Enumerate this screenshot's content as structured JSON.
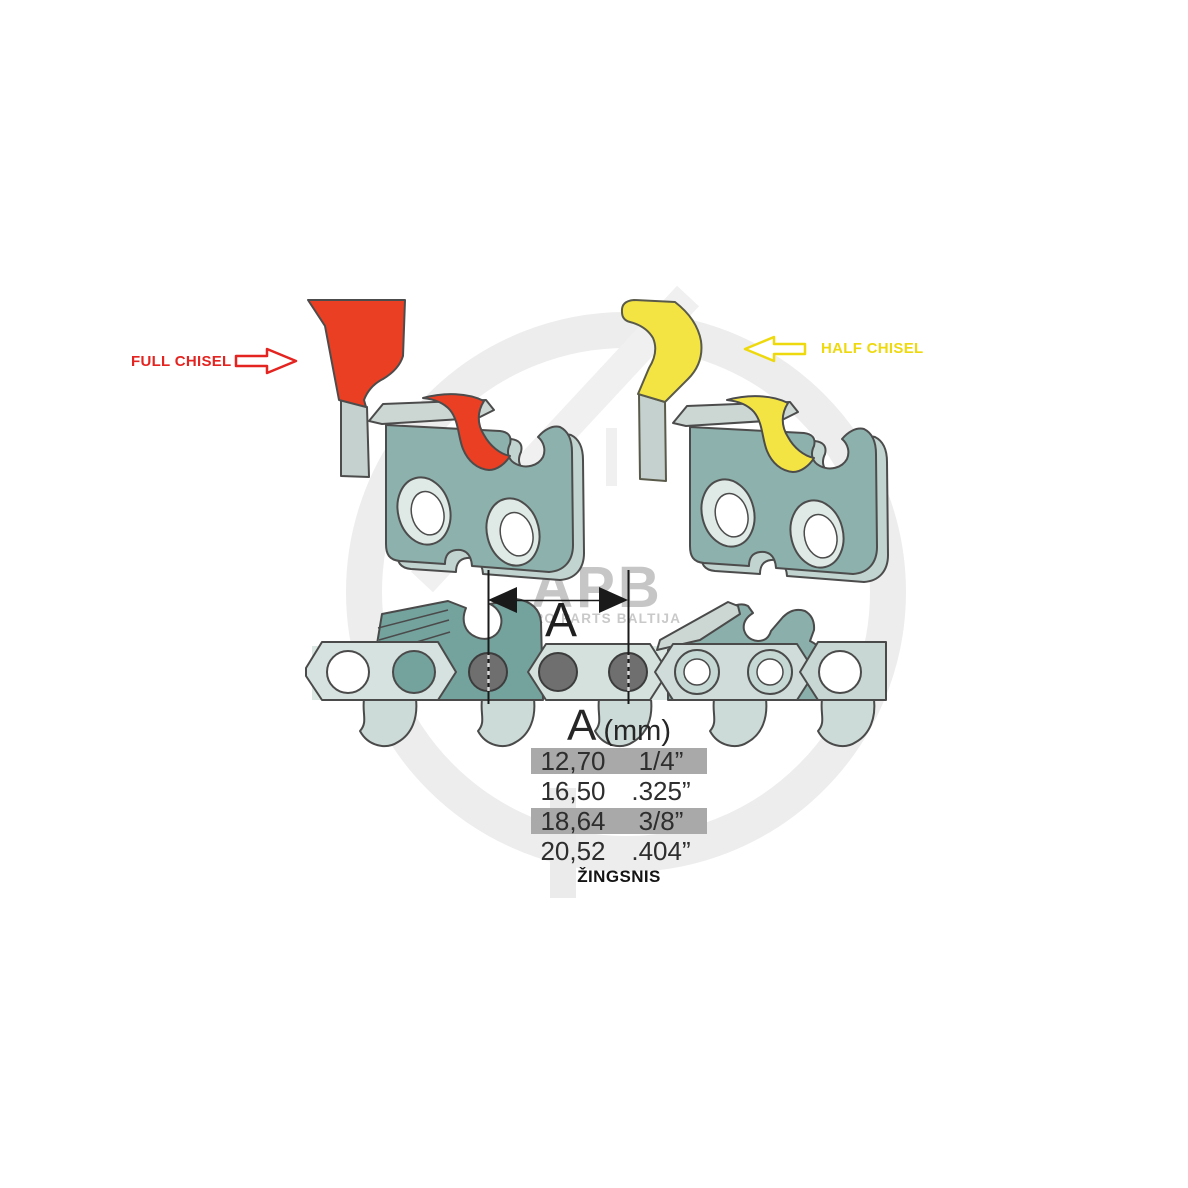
{
  "labels": {
    "full_chisel": "FULL CHISEL",
    "half_chisel": "HALF CHISEL"
  },
  "dimension": {
    "label": "A"
  },
  "pitch_table": {
    "header": {
      "symbol": "A",
      "unit": "(mm)"
    },
    "rows": [
      {
        "mm": "12,70",
        "inch": "1/4”",
        "highlighted": true
      },
      {
        "mm": "16,50",
        "inch": ".325”",
        "highlighted": false
      },
      {
        "mm": "18,64",
        "inch": "3/8”",
        "highlighted": true
      },
      {
        "mm": "20,52",
        "inch": ".404”",
        "highlighted": false
      }
    ],
    "caption": "ŽINGSNIS"
  },
  "watermark": {
    "brand": "APB",
    "tagline": "AGRO PARTS BALTIJA"
  },
  "colors": {
    "full_chisel_red": "#ea3f23",
    "full_chisel_label_red": "#e32420",
    "half_chisel_yellow": "#f4e443",
    "half_chisel_label_yellow": "#eed90f",
    "link_teal": "#8db1ac",
    "chain_cutter_teal": "#74a29d",
    "row_highlight_gray": "#a9a9a9",
    "rivet_gray": "#6f6f6f"
  }
}
